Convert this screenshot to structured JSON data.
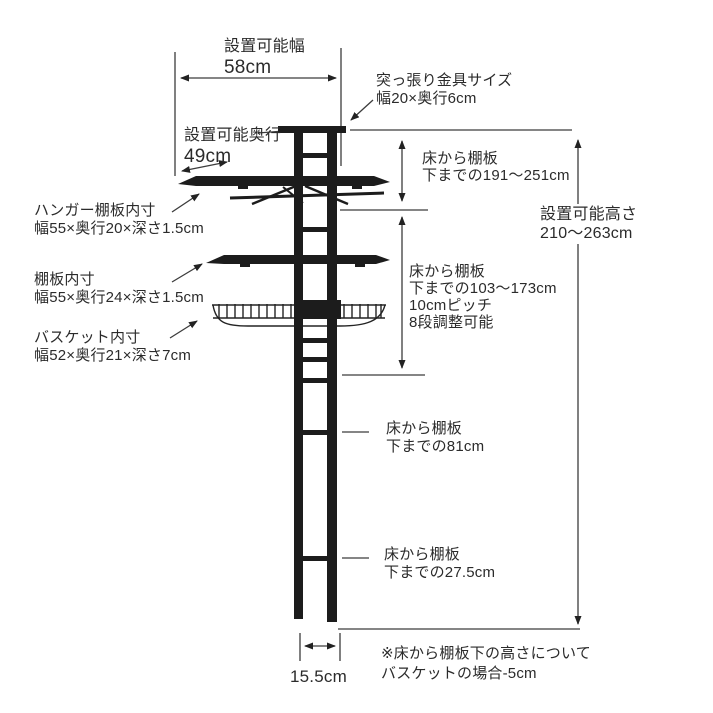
{
  "colors": {
    "background": "#ffffff",
    "structure": "#1c1c1c",
    "dimension_line": "#3c3c3c",
    "text": "#2b2b2b"
  },
  "ann": {
    "install_width": {
      "l1": "設置可能幅",
      "l2": "58cm"
    },
    "bracket_size": {
      "l1": "突っ張り金具サイズ",
      "l2": "幅20×奥行6cm"
    },
    "install_depth": {
      "l1": "設置可能奥行",
      "l2": "49cm"
    },
    "floor_to_shelf_top": {
      "l1": "床から棚板",
      "l2": "下までの191〜251cm"
    },
    "install_height": {
      "l1": "設置可能高さ",
      "l2": "210〜263cm"
    },
    "hanger_shelf_inner": {
      "l1": "ハンガー棚板内寸",
      "l2": "幅55×奥行20×深さ1.5cm"
    },
    "floor_to_shelf_adjust": {
      "l1": "床から棚板",
      "l2": "下までの103〜173cm",
      "l3": "10cmピッチ",
      "l4": "8段調整可能"
    },
    "shelf_inner": {
      "l1": "棚板内寸",
      "l2": "幅55×奥行24×深さ1.5cm"
    },
    "basket_inner": {
      "l1": "バスケット内寸",
      "l2": "幅52×奥行21×深さ7cm"
    },
    "floor_to_shelf_81": {
      "l1": "床から棚板",
      "l2": "下までの81cm"
    },
    "floor_to_shelf_275": {
      "l1": "床から棚板",
      "l2": "下までの27.5cm"
    },
    "base_width": {
      "value": "15.5cm"
    },
    "footnote": {
      "l1": "※床から棚板下の高さについて",
      "l2": "バスケットの場合-5cm"
    }
  }
}
